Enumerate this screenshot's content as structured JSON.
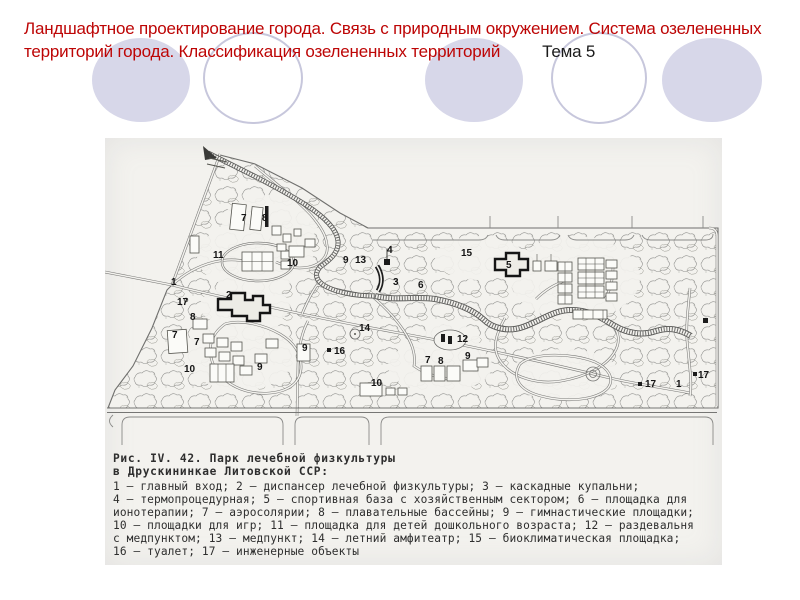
{
  "title": {
    "line1": "Ландшафтное проектирование города. Связь с природным окружением.  Система озелененных",
    "line2": "территорий города. Классификация озелененных территорий",
    "topic": "Тема 5",
    "title_color": "#bd0505",
    "topic_color": "#1a1a1a"
  },
  "decor": {
    "circle_fill": "#d7d7e9",
    "circle_outline": "#c7c7dc"
  },
  "figure": {
    "caption_line1": "Рис. IV. 42. Парк лечебной физкультуры",
    "caption_line2": "в Друскининкае Литовской ССР:",
    "legend": [
      "1 — главный вход; 2 — диспансер лечебной физкультуры; 3 — каскадные купальни;",
      "4 — термопроцедурная; 5 — спортивная база с хозяйственным сектором; 6 — площадка для",
      "ионотерапии; 7 — аэросолярии; 8 — плавательные бассейны; 9 — гимнастические площадки;",
      "10 — площадки для игр; 11 — площадка для детей дошкольного возраста; 12 — раздевальня",
      "с медпунктом; 13 — медпункт; 14 — летний амфитеатр; 15 — биоклиматическая площадка;",
      "16 — туалет; 17 — инженерные объекты"
    ],
    "map_labels": [
      {
        "n": "7",
        "x": 136,
        "y": 83
      },
      {
        "n": "8",
        "x": 157,
        "y": 83
      },
      {
        "n": "11",
        "x": 108,
        "y": 120
      },
      {
        "n": "10",
        "x": 182,
        "y": 128
      },
      {
        "n": "9",
        "x": 238,
        "y": 125
      },
      {
        "n": "13",
        "x": 250,
        "y": 125
      },
      {
        "n": "4",
        "x": 282,
        "y": 115
      },
      {
        "n": "3",
        "x": 288,
        "y": 147
      },
      {
        "n": "6",
        "x": 313,
        "y": 150
      },
      {
        "n": "15",
        "x": 356,
        "y": 118
      },
      {
        "n": "5",
        "x": 401,
        "y": 130
      },
      {
        "n": "1",
        "x": 66,
        "y": 147
      },
      {
        "n": "17",
        "x": 72,
        "y": 167
      },
      {
        "n": "2",
        "x": 121,
        "y": 160
      },
      {
        "n": "8",
        "x": 85,
        "y": 182
      },
      {
        "n": "7",
        "x": 67,
        "y": 200
      },
      {
        "n": "7",
        "x": 89,
        "y": 207
      },
      {
        "n": "10",
        "x": 79,
        "y": 234
      },
      {
        "n": "9",
        "x": 152,
        "y": 232
      },
      {
        "n": "9",
        "x": 197,
        "y": 213
      },
      {
        "n": "14",
        "x": 254,
        "y": 193
      },
      {
        "n": "16",
        "x": 229,
        "y": 216
      },
      {
        "n": "12",
        "x": 352,
        "y": 204
      },
      {
        "n": "7",
        "x": 320,
        "y": 225
      },
      {
        "n": "8",
        "x": 333,
        "y": 226
      },
      {
        "n": "9",
        "x": 360,
        "y": 221
      },
      {
        "n": "10",
        "x": 266,
        "y": 248
      },
      {
        "n": "17",
        "x": 540,
        "y": 249
      },
      {
        "n": "1",
        "x": 571,
        "y": 249
      },
      {
        "n": "17",
        "x": 593,
        "y": 240
      }
    ]
  }
}
